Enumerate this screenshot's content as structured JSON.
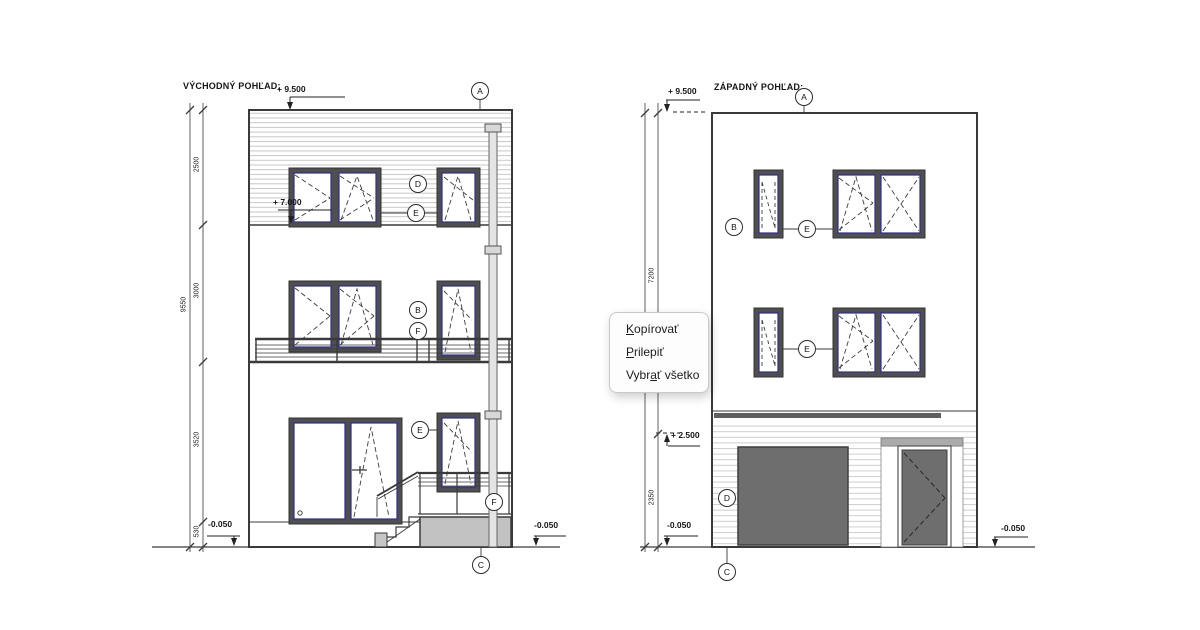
{
  "east": {
    "title": "VÝCHODNÝ POHĽAD:",
    "levels": {
      "top": "+ 9.500",
      "mid": "+ 7.000",
      "base_left": "-0.050",
      "base_right": "-0.050"
    },
    "dims": {
      "d1": "2500",
      "d2": "3000",
      "d3": "3520",
      "d4": "530",
      "total": "9550"
    },
    "bubbles": {
      "a": "A",
      "d": "D",
      "e_top": "E",
      "b": "B",
      "f_mid": "F",
      "e_ground": "E",
      "f_ground": "F",
      "c": "C"
    }
  },
  "west": {
    "title": "ZÁPADNÝ POHĽAD:",
    "levels": {
      "top": "+ 9.500",
      "garage": "+ 2.500",
      "base_left": "-0.050",
      "base_right": "-0.050"
    },
    "dims": {
      "upper": "7200",
      "lower": "2350"
    },
    "bubbles": {
      "a": "A",
      "b": "B",
      "e_upper": "E",
      "e_lower": "E",
      "d": "D",
      "c": "C"
    }
  },
  "context_menu": {
    "items": [
      {
        "pre": "",
        "accel": "K",
        "post": "opírovať"
      },
      {
        "pre": "",
        "accel": "P",
        "post": "rilepiť"
      },
      {
        "pre": "Vybr",
        "accel": "a",
        "post": "ť všetko"
      }
    ]
  },
  "colors": {
    "window_frame_dark": "#4f4f4f",
    "window_lining_blue": "#2e2e96",
    "door_panel_gray": "#6e6e6e",
    "base_block_gray": "#c2c2c2"
  }
}
